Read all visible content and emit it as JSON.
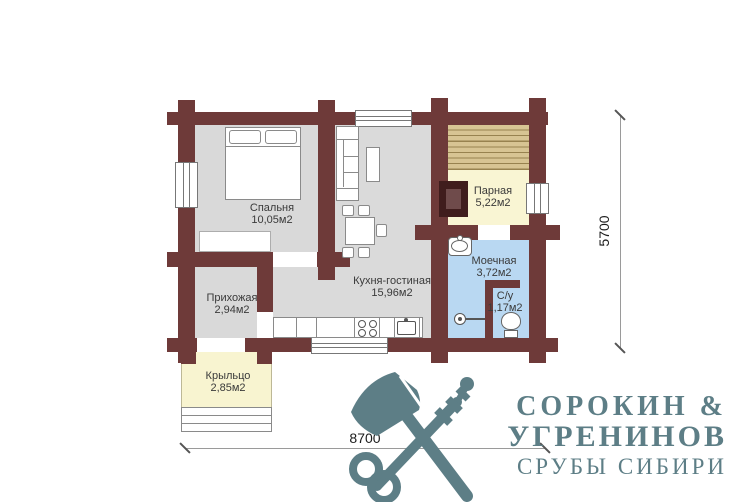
{
  "rooms": [
    {
      "key": "bedroom",
      "name": "Спальня",
      "area": "10,05м2"
    },
    {
      "key": "kitchen_living",
      "name": "Кухня-гостиная",
      "area": "15,96м2"
    },
    {
      "key": "hallway",
      "name": "Прихожая",
      "area": "2,94м2"
    },
    {
      "key": "steam_room",
      "name": "Парная",
      "area": "5,22м2"
    },
    {
      "key": "washing_room",
      "name": "Моечная",
      "area": "3,72м2"
    },
    {
      "key": "wc",
      "name": "С/у",
      "area": "1,17м2"
    },
    {
      "key": "porch",
      "name": "Крыльцо",
      "area": "2,85м2"
    }
  ],
  "dimensions": {
    "width": "8700",
    "height": "5700"
  },
  "logo": {
    "line1": "СОРОКИН &",
    "line2": "УГРЕНИНОВ",
    "line3": "СРУБЫ СИБИРИ"
  },
  "colors": {
    "wall": "#6e3a39",
    "floor_gray": "#d9d9d9",
    "floor_sauna": "#f9f5d3",
    "floor_wet": "#b9d8f2",
    "floor_porch": "#f8f4d0",
    "bench_wood": "#d7c493",
    "stove_dark": "#401d1d",
    "logo_teal": "#5d7e86"
  }
}
